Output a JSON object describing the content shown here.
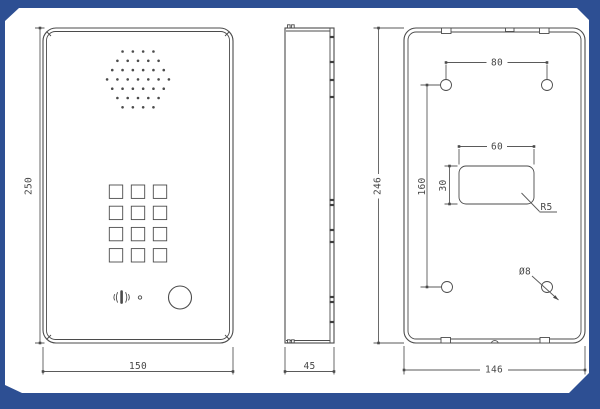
{
  "colors": {
    "frame_blue": "#2d4f93",
    "paper": "#ffffff",
    "line": "#4b4b4b",
    "dim_line": "#5a5a5a",
    "text": "#474747"
  },
  "dimensions": {
    "front_height": "250",
    "front_width": "150",
    "side_depth": "45",
    "back_height": "246",
    "back_width": "146",
    "top_hole_spacing": "80",
    "cutout_width": "60",
    "cutout_height": "30",
    "hole_vertical_spacing": "160",
    "corner_radius": "R5",
    "hole_diameter": "Ø8"
  },
  "speaker_grille": {
    "rows": [
      4,
      5,
      6,
      7,
      6,
      5,
      4
    ],
    "center_x": 138,
    "start_y": 51.5,
    "row_step": 9.3,
    "dot_pitch": 10.3,
    "dot_radius": 1.3
  },
  "keypad": {
    "columns": 3,
    "rows": 4,
    "origin_x": 109.3,
    "origin_y": 185,
    "pitch_x": 22,
    "pitch_y": 21.2,
    "key_size": 13.4
  },
  "side_view_ticks": [
    37,
    62,
    80,
    97,
    200,
    205,
    230,
    242,
    297,
    302,
    322
  ]
}
